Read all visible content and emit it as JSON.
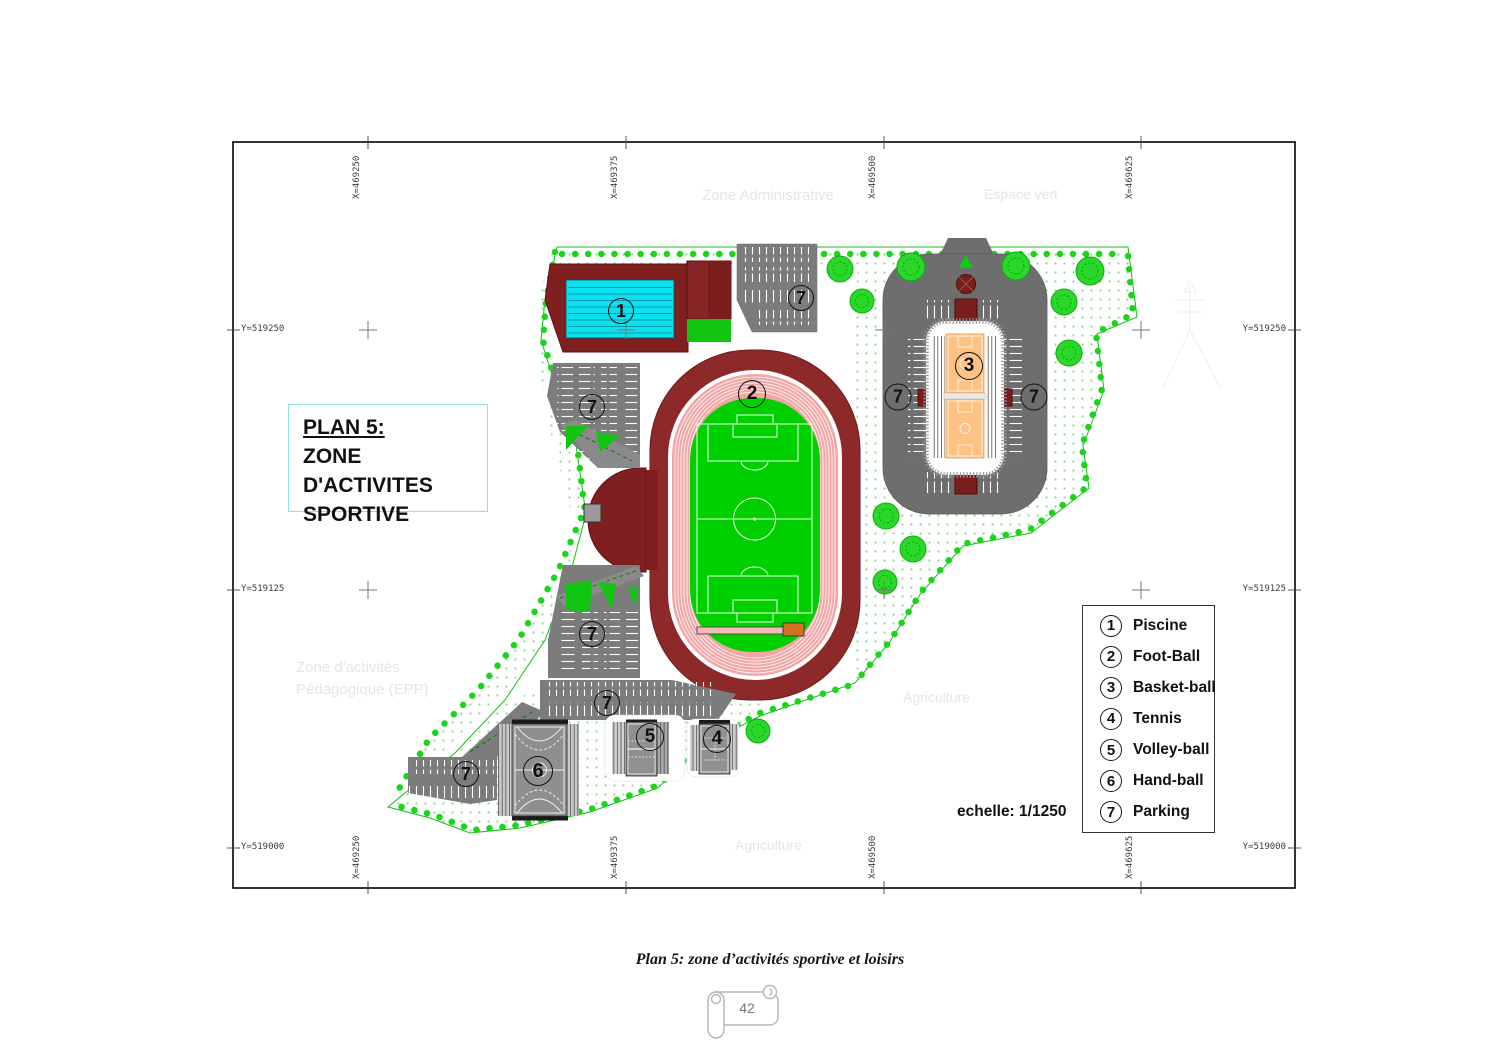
{
  "title_box": {
    "line1": "PLAN 5:",
    "line2": "ZONE D'ACTIVITES",
    "line3": "SPORTIVE"
  },
  "legend": {
    "items": [
      {
        "num": "1",
        "label": "Piscine"
      },
      {
        "num": "2",
        "label": "Foot-Ball"
      },
      {
        "num": "3",
        "label": "Basket-ball"
      },
      {
        "num": "4",
        "label": "Tennis"
      },
      {
        "num": "5",
        "label": "Volley-ball"
      },
      {
        "num": "6",
        "label": "Hand-ball"
      },
      {
        "num": "7",
        "label": "Parking"
      }
    ]
  },
  "scale_label": "echelle: 1/1250",
  "caption": "Plan 5: zone d’activités sportive et loisirs",
  "page_number": "42",
  "coordinates": {
    "x": [
      "X=469250",
      "X=469375",
      "X=469500",
      "X=469625"
    ],
    "y": [
      "Y=519250",
      "Y=519125",
      "Y=519000"
    ]
  },
  "watermarks": {
    "top_left": "Zone Administrative",
    "top_right": "Espace vert",
    "mid_left_line1": "Zone d'activités",
    "mid_left_line2": "Pédagogique (EPP)",
    "mid_right": "Agriculture",
    "bottom": "Agriculture"
  },
  "markers": {
    "piscine": "1",
    "football": "2",
    "basket": "3",
    "tennis": "4",
    "volley": "5",
    "hand": "6",
    "parking": "7"
  },
  "colors": {
    "building": "#7f1f1f",
    "stadium_ring": "#8d2929",
    "track": "#f2a6a6",
    "field": "#00cf00",
    "pool": "#0ae0ee",
    "parking": "#7c7c7c",
    "court_orange": "#ffc285",
    "tree": "#29d829",
    "boundary": "#10c010",
    "title_border": "#94e2e2"
  }
}
